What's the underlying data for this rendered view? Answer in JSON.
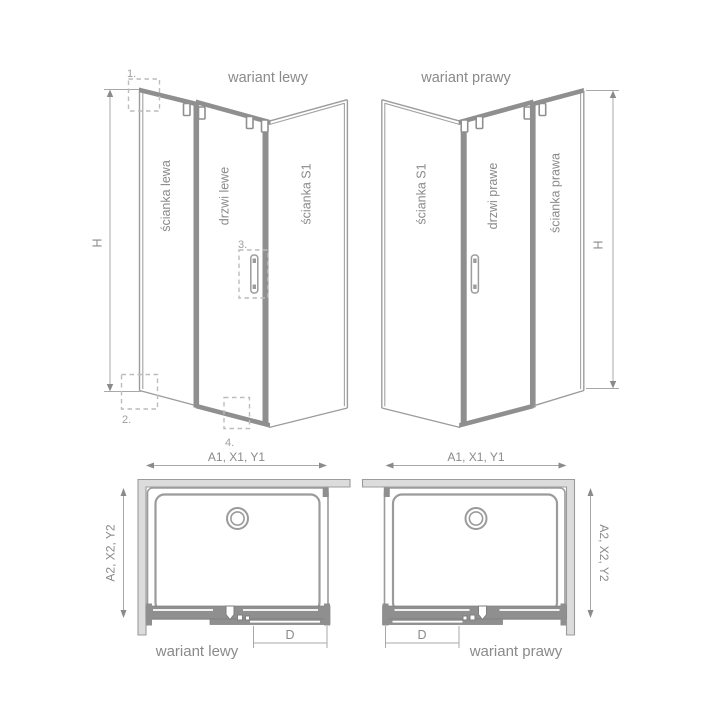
{
  "colors": {
    "background": "#ffffff",
    "line_gray": "#9c9c9c",
    "frame_bar_gray": "#8f8f8f",
    "wall_fill_gray": "#dcdcdc",
    "text_gray": "#8a8a8a",
    "callout_gray": "#9f9f9f",
    "dashed_box_gray": "#bcbcbc"
  },
  "v3d": {
    "left": {
      "title": "wariant lewy",
      "panel1": "ścianka lewa",
      "panel2": "drzwi lewe",
      "panel3": "ścianka S1",
      "h": "H",
      "c1": "1.",
      "c2": "2.",
      "c3": "3.",
      "c4": "4."
    },
    "right": {
      "title": "wariant prawy",
      "panel1": "ścianka S1",
      "panel2": "drzwi prawe",
      "panel3": "ścianka prawa",
      "h": "H"
    }
  },
  "plan": {
    "left": {
      "caption": "wariant lewy",
      "top": "A1, X1, Y1",
      "side": "A2, X2, Y2",
      "door": "D"
    },
    "right": {
      "caption": "wariant prawy",
      "top": "A1, X1, Y1",
      "side": "A2, X2, Y2",
      "door": "D"
    }
  }
}
